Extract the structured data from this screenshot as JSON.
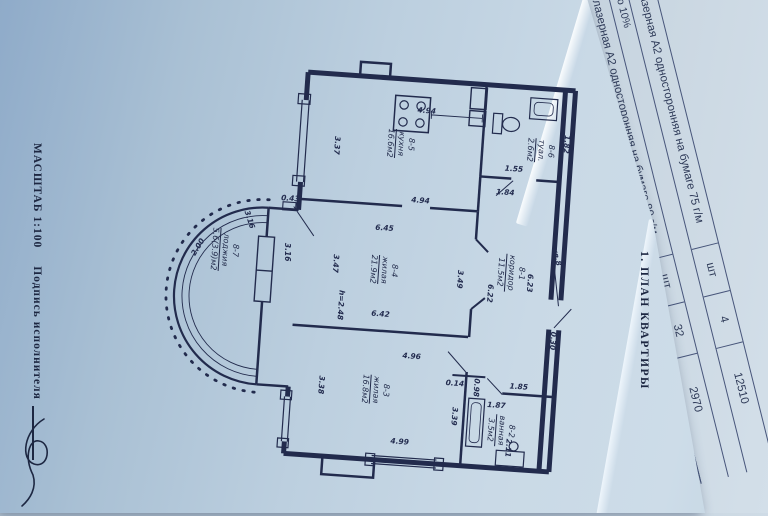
{
  "photo": {
    "paper_blue": "#b9cfdf",
    "shadow_blue": "#8fabc9",
    "ink": "#222b4d",
    "underlay_paper": "#ccd9e3",
    "underlay_ink": "#2e3a58"
  },
  "form": {
    "scale_label": "МАСШТАБ 1:100",
    "signer_label": "Подпись исполнителя",
    "section_title": "1. ПЛАН КВАРТИРЫ"
  },
  "plan": {
    "door_label": "кв.8",
    "rooms": [
      {
        "num": "8-5",
        "name": "кухня",
        "area": "16.6м2",
        "x": 232,
        "y": 95
      },
      {
        "num": "8-6",
        "name": "туал.",
        "area": "2.6м2",
        "x": 372,
        "y": 92
      },
      {
        "num": "8-1",
        "name": "коридор",
        "area": "11.5м2",
        "x": 351,
        "y": 216
      },
      {
        "num": "8-4",
        "name": "жилая",
        "area": "21.9м2",
        "x": 224,
        "y": 222
      },
      {
        "num": "8-3",
        "name": "жилая",
        "area": "16.8м2",
        "x": 224,
        "y": 342
      },
      {
        "num": "8-2",
        "name": "ванная",
        "area": "3.5м2",
        "x": 352,
        "y": 374
      },
      {
        "num": "8-7",
        "name": "лоджия",
        "area": "5.6(3.9)м2",
        "x": 64,
        "y": 213
      }
    ],
    "dims": [
      {
        "t": "4.94",
        "x": 256,
        "y": 60,
        "r": 0
      },
      {
        "t": "4.94",
        "x": 256,
        "y": 150,
        "r": 0
      },
      {
        "t": "6.45",
        "x": 222,
        "y": 180,
        "r": 0
      },
      {
        "t": "6.42",
        "x": 224,
        "y": 266,
        "r": 0
      },
      {
        "t": "4.96",
        "x": 258,
        "y": 306,
        "r": 0
      },
      {
        "t": "4.99",
        "x": 252,
        "y": 392,
        "r": 0
      },
      {
        "t": "1.55",
        "x": 347,
        "y": 112,
        "r": 0
      },
      {
        "t": "1.84",
        "x": 340,
        "y": 136,
        "r": 0
      },
      {
        "t": "1.85",
        "x": 367,
        "y": 329,
        "r": 0
      },
      {
        "t": "1.87",
        "x": 346,
        "y": 349,
        "r": 0
      },
      {
        "t": "0.43",
        "x": 126,
        "y": 157,
        "r": 0
      },
      {
        "t": "0.14",
        "x": 303,
        "y": 330,
        "r": 0
      },
      {
        "t": "3.37",
        "x": 169,
        "y": 101,
        "r": 90
      },
      {
        "t": "3.47",
        "x": 176,
        "y": 219,
        "r": 90
      },
      {
        "t": "3.49",
        "x": 301,
        "y": 226,
        "r": 90
      },
      {
        "t": "6.23",
        "x": 371,
        "y": 225,
        "r": 90
      },
      {
        "t": "6.22",
        "x": 332,
        "y": 238,
        "r": 90
      },
      {
        "t": "1.82",
        "x": 398,
        "y": 84,
        "r": 90
      },
      {
        "t": "3.38",
        "x": 170,
        "y": 341,
        "r": 90
      },
      {
        "t": "3.39",
        "x": 305,
        "y": 363,
        "r": 90
      },
      {
        "t": "0.98",
        "x": 325,
        "y": 333,
        "r": 90
      },
      {
        "t": "2.11",
        "x": 361,
        "y": 391,
        "r": 90
      },
      {
        "t": "0.30",
        "x": 398,
        "y": 281,
        "r": 90
      },
      {
        "t": "h=2.48",
        "x": 184,
        "y": 260,
        "r": 90
      },
      {
        "t": "3.16",
        "x": 87,
        "y": 181,
        "r": 68
      },
      {
        "t": "3.16",
        "x": 127,
        "y": 211,
        "r": 86
      },
      {
        "t": "2.00",
        "x": 37,
        "y": 212,
        "r": -62
      },
      {
        "t": "кв.8",
        "x": 396,
        "y": 197,
        "r": 72
      }
    ]
  },
  "underlay": {
    "rows": [
      {
        "type": "item",
        "desc": "Ксерокопия лазерная А2 односторонняя на бумаге 75 г/м",
        "unit": "шт",
        "qty": "4",
        "price": "12510"
      },
      {
        "type": "note",
        "text": "о 10%"
      },
      {
        "type": "item",
        "desc": "Ксерокопия лазерная А2 односторонняя на бумаге 80 г/м",
        "unit": "шт",
        "qty": "32",
        "price": "2970"
      },
      {
        "type": "item",
        "desc": "Ксерокопия лазерная",
        "unit": "шт",
        "qty": "2",
        "price": "1485"
      },
      {
        "type": "note",
        "text": "о 10%"
      },
      {
        "type": "frag",
        "text": "Ксерок"
      },
      {
        "type": "frag",
        "text": "Скани"
      },
      {
        "type": "frag",
        "text": "автома"
      },
      {
        "type": "frag",
        "text": "Расте"
      },
      {
        "type": "frag",
        "text": "Фальц"
      }
    ]
  }
}
